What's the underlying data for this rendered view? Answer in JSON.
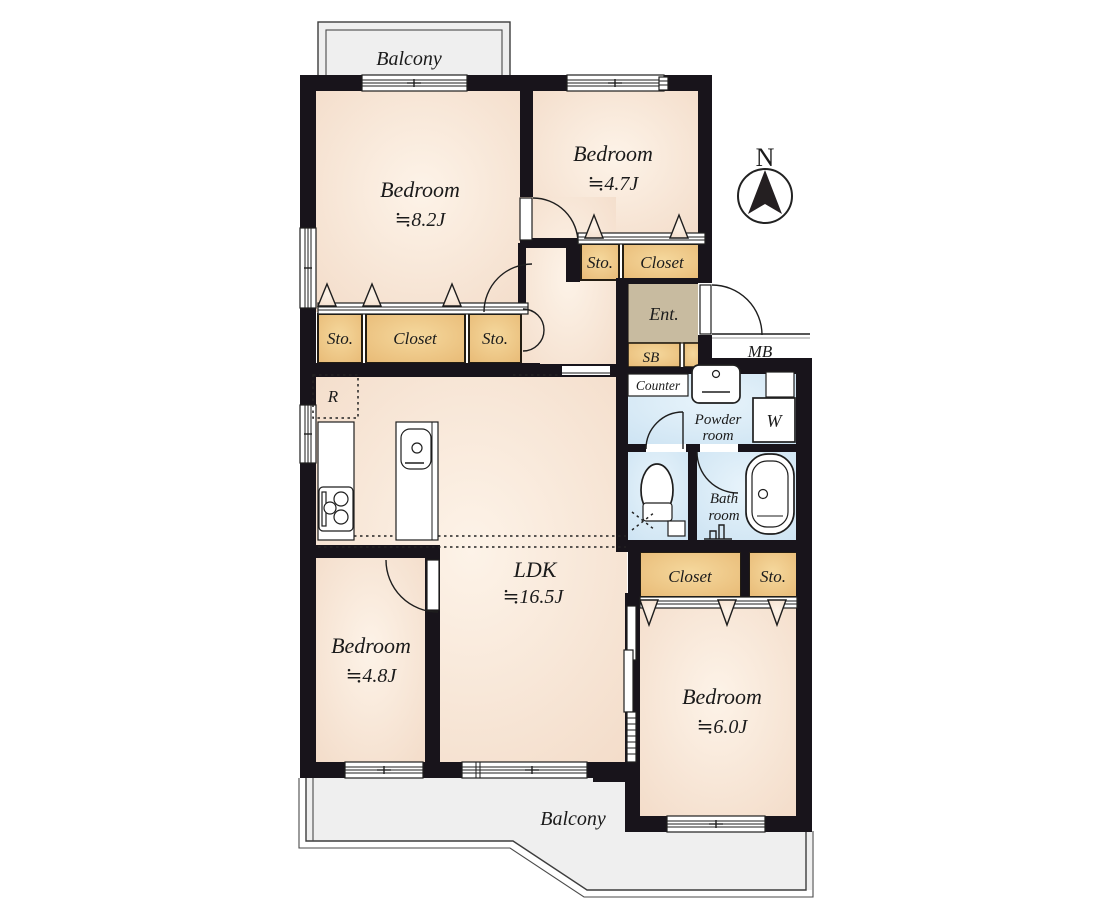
{
  "plan": {
    "north_label": "N",
    "balcony_top": "Balcony",
    "balcony_bottom": "Balcony",
    "rooms": {
      "bedroom_nw": {
        "name": "Bedroom",
        "size": "≒8.2J"
      },
      "bedroom_n": {
        "name": "Bedroom",
        "size": "≒4.7J"
      },
      "bedroom_sw": {
        "name": "Bedroom",
        "size": "≒4.8J"
      },
      "bedroom_se": {
        "name": "Bedroom",
        "size": "≒6.0J"
      },
      "ldk": {
        "name": "LDK",
        "size": "≒16.5J"
      },
      "entrance": "Ent.",
      "powder_line1": "Powder",
      "powder_line2": "room",
      "bath_line1": "Bath",
      "bath_line2": "room",
      "counter": "Counter"
    },
    "storage": {
      "sto_nw_left": "Sto.",
      "closet_nw": "Closet",
      "sto_nw_right": "Sto.",
      "sto_hall": "Sto.",
      "closet_hall": "Closet",
      "closet_se": "Closet",
      "sto_se": "Sto.",
      "shoe_box": "SB",
      "meter_box": "MB",
      "refrigerator": "R",
      "washer": "W"
    },
    "colors": {
      "wall": "#18141b",
      "room_fill": "#f3dcc9",
      "room_fill_light": "#fdf3e8",
      "closet_fill": "#e7b873",
      "closet_fill_light": "#f5d89d",
      "entrance_fill": "#c8bba0",
      "water_fill": "#cbe2f2",
      "water_fill_light": "#e8f4fb",
      "balcony_fill": "#efefef"
    }
  }
}
